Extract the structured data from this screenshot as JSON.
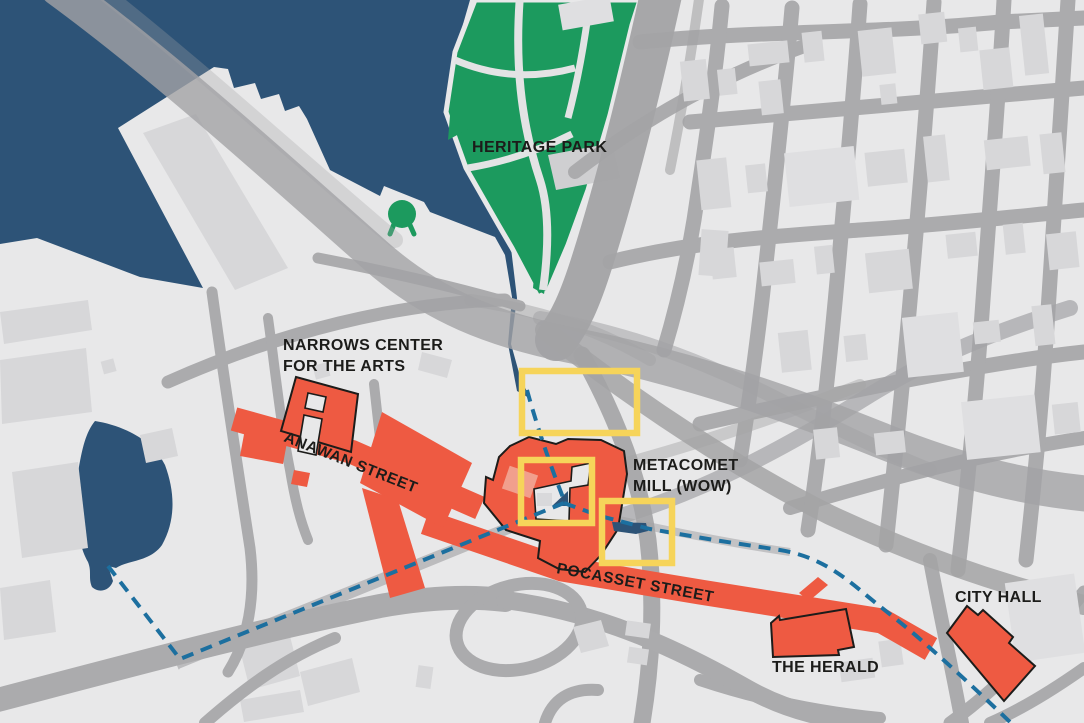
{
  "map": {
    "labels": {
      "heritage_park": "HERITAGE PARK",
      "narrows_line1": "NARROWS CENTER",
      "narrows_line2": "FOR THE ARTS",
      "anawan_street": "ANAWAN STREET",
      "metacomet_line1": "METACOMET",
      "metacomet_line2": "MILL (WOW)",
      "pocasset_street": "POCASSET STREET",
      "the_herald": "THE HERALD",
      "city_hall": "CITY HALL"
    },
    "palette": {
      "water": "#2d5377",
      "land": "#e8e8e9",
      "building": "#d7d7d9",
      "road": "#ababad",
      "park_green": "#1c9a5e",
      "landmark_red": "#ee5a42",
      "highlight_yellow": "#f6d45a",
      "route_blue": "#1c6f9f",
      "label_black": "#1c1c1a"
    }
  }
}
